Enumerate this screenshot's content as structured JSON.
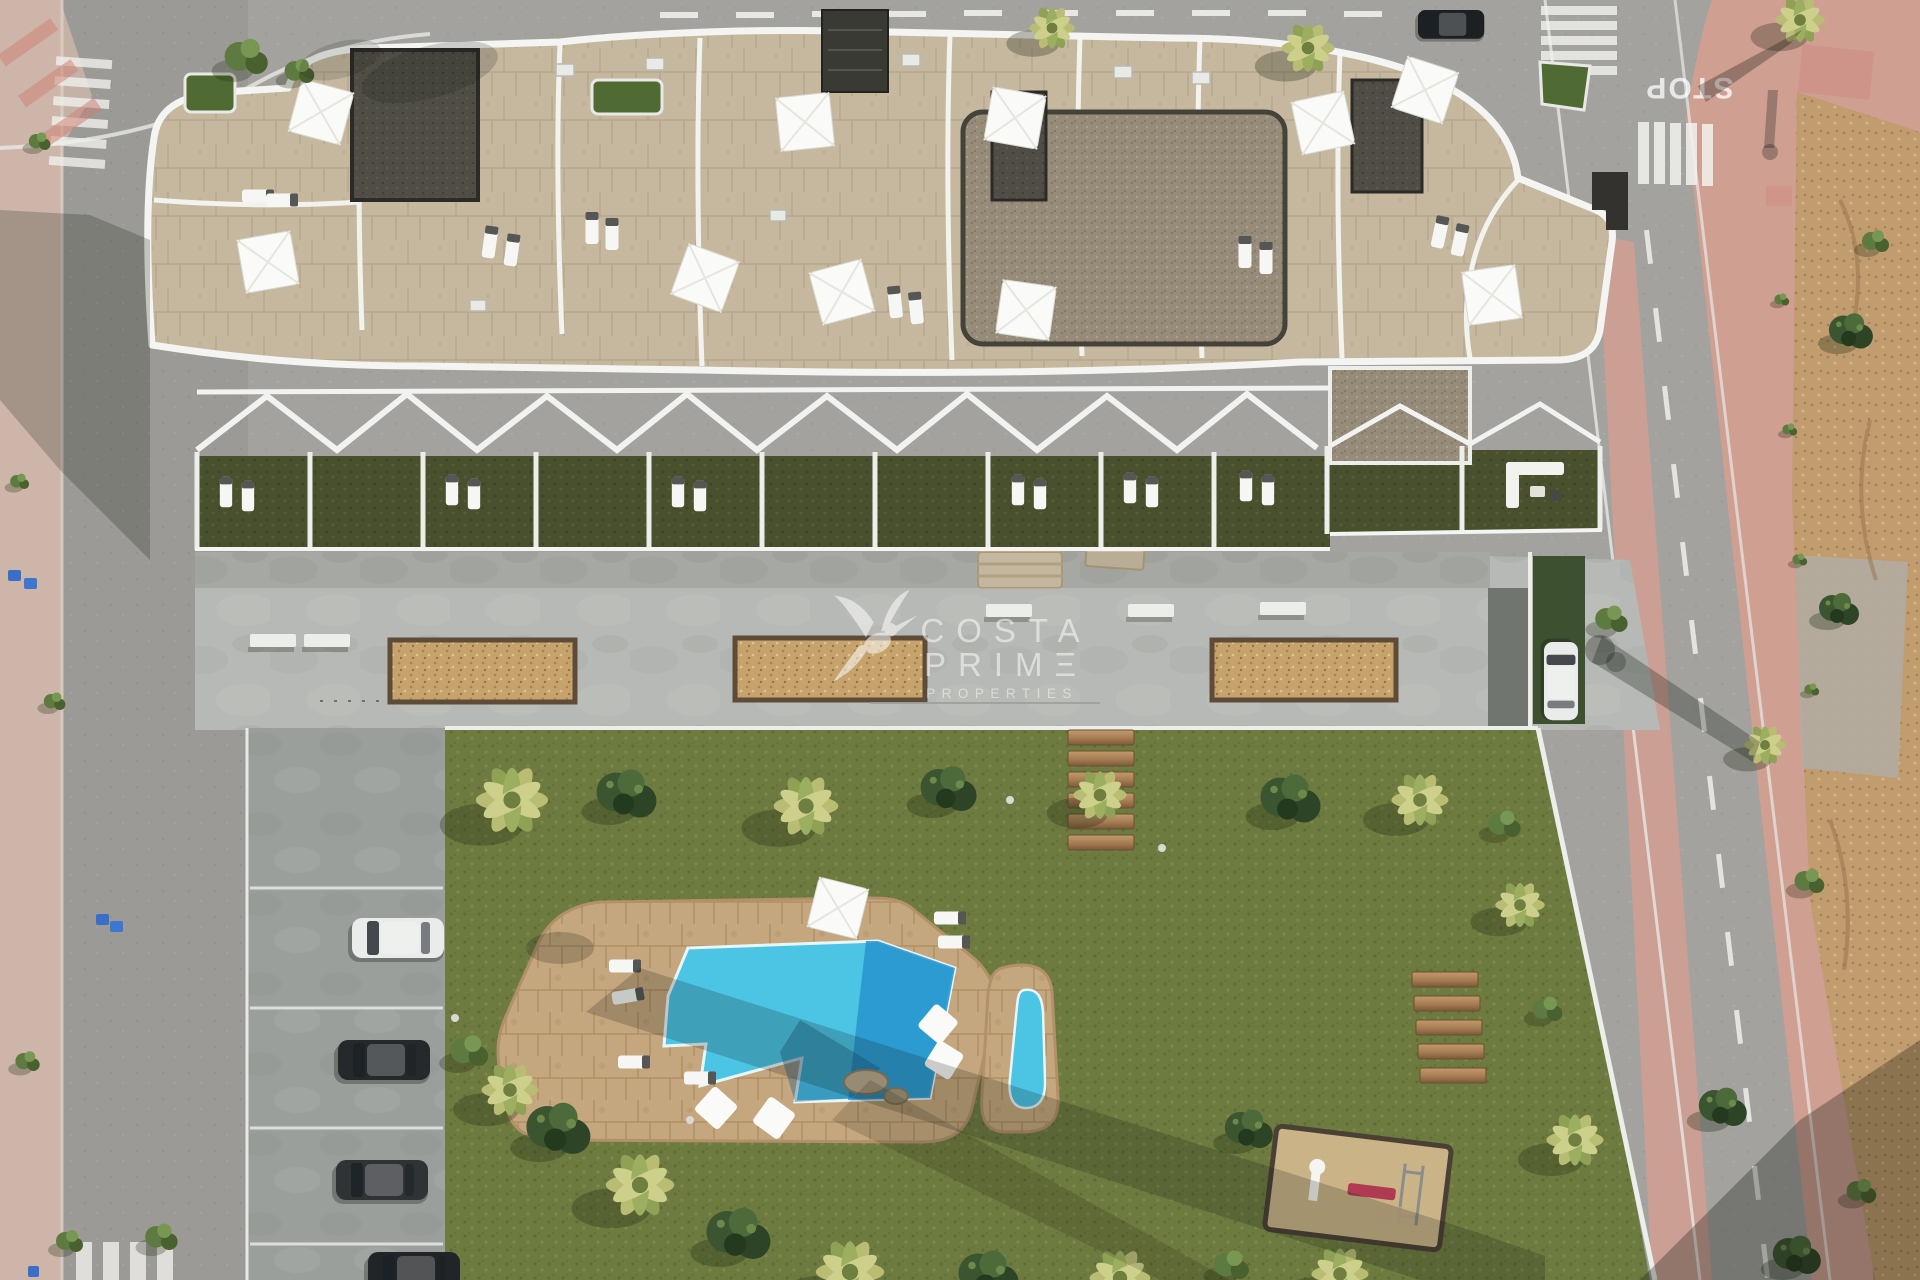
{
  "title": "Aerial render of seaside apartment complex with communal garden and pools",
  "watermark": {
    "logo": "hummingbird-icon",
    "line1": "COSTA",
    "line2": "PRIMΞ",
    "line3": "PROPERTIES"
  },
  "road_markings": {
    "stop_text": "STOP"
  },
  "scene_summary": {
    "rooftop_umbrellas": 10,
    "ground_floor_terraces": 12,
    "planter_boxes": 3,
    "pools": 2,
    "parked_cars_left": 4,
    "parked_cars_right": 2,
    "wooden_steps": 6,
    "wooden_benches": 5
  },
  "colors": {
    "asphalt": "#a3a29f",
    "asphalt_left": "#9b9a97",
    "concrete": "#b6b9b5",
    "concrete_dark": "#9b9f9c",
    "grass": "#6e7b40",
    "lawn_private": "#49502e",
    "water": "#4cc4e4",
    "water_deep": "#2694cf",
    "pool_deck": "#c4a77e",
    "building_paver": "#c6b89f",
    "gravel": "#978c7a",
    "gravel_dark": "#504d46",
    "planter_chips": "#c6a36c",
    "dirt": "#c09c6e",
    "sidewalk_pink": "#cf9f92",
    "sidewalk_left": "#cdb6a9",
    "white_trim": "#f2f3f1",
    "wood_plank": "#a97f55",
    "hedge_green": "#31491f",
    "palm_yellow": "#b9bd74",
    "palm_green": "#8ea155",
    "shrub_dark": "#3c5531",
    "car_white": "#e9ecea",
    "car_dark": "#2a2d30",
    "umbrella": "#fafaf8",
    "gym_red": "#b03a52",
    "watermark": "#ffffff"
  }
}
